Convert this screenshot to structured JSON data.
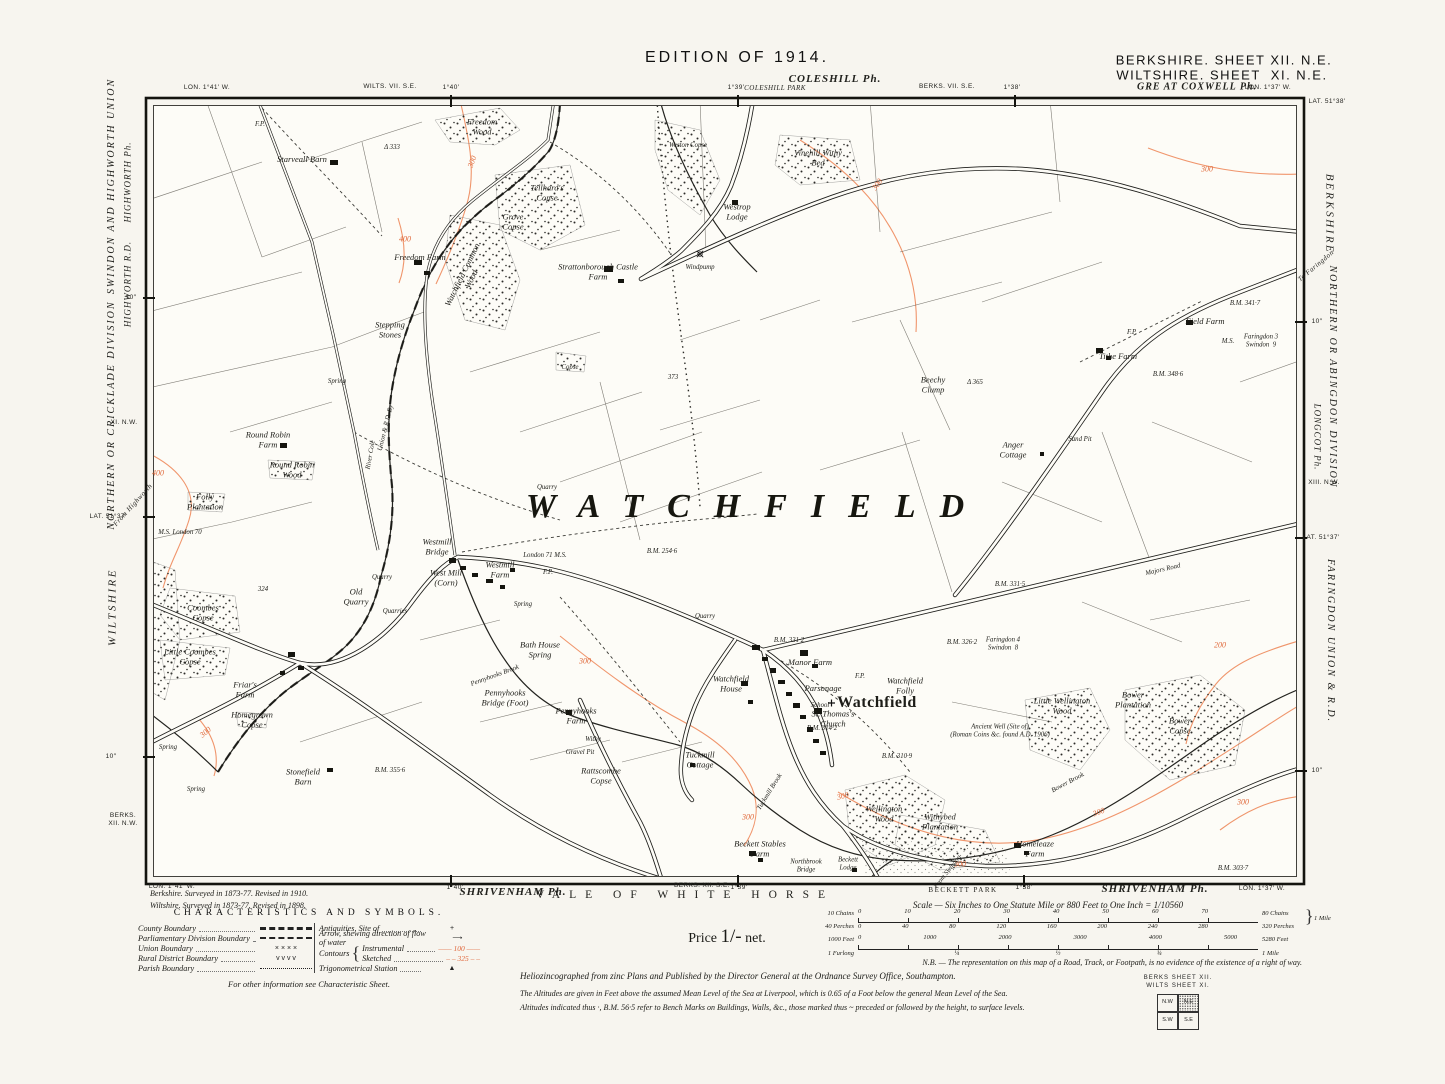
{
  "header": {
    "edition": "EDITION OF 1914.",
    "sheet_line1": "BERKSHIRE. SHEET XII. N.E.",
    "sheet_line2": "WILTSHIRE. SHEET  XI. N.E.",
    "great_coxwell": "GRE AT COXWELL Ph.",
    "coleshill": "COLESHILL Ph.",
    "coleshill_park": "COLESHILL PARK",
    "wilts_sheet": "WILTS. VII. S.E.",
    "berks_sheet": "BERKS. VII. S.E.",
    "lon_left": "LON. 1°41′ W.",
    "lon_right": "LON. 1°37′ W.",
    "lat_right": "LAT. 51°38′",
    "t140": "1°40′",
    "t139": "1°39′",
    "t138": "1°38′"
  },
  "margin_left": {
    "union": "SWINDON AND HIGHWORTH UNION",
    "parish": "HIGHWORTH Ph.",
    "rd": "HIGHWORTH R.D.",
    "division": "NORTHERN OR CRICKLADE DIVISION",
    "sheet_adj": "XI. N.W.",
    "lat": "LAT. 51°37′",
    "from_road": "From Highworth",
    "county": "WILTSHIRE",
    "sheet_corner": "BERKS.\nXII. N.W.",
    "tick": "10″"
  },
  "margin_right": {
    "county": "BERKSHIRE",
    "to_road": "To Faringdon",
    "division": "NORTHERN OR ABINGDON DIVISION",
    "parish": "LONGCOT Ph.",
    "sheet_adj": "XIII. N.W.",
    "lat": "LAT. 51°37′",
    "union": "FARINGDON UNION & R.D.",
    "tick": "10″"
  },
  "margin_bottom": {
    "lon_left": "LON. 1°41′ W.",
    "t140": "1°40′",
    "shrivenham_left": "SHRIVENHAM Ph.",
    "vale": "VALE OF WHITE HORSE",
    "berks_sheet": "BERKS. XII. S.E.",
    "t139": "1°39′",
    "beckett": "BECKETT PARK",
    "t138": "1°38′",
    "shrivenham_right": "SHRIVENHAM Ph.",
    "lon_right": "LON. 1°37′ W."
  },
  "map": {
    "big_label": "WATCHFIELD",
    "labels": [
      {
        "t": "F.P.",
        "x": 260,
        "y": 125,
        "c": "t"
      },
      {
        "t": "Freedom\nWood",
        "x": 482,
        "y": 127
      },
      {
        "t": "Starveall Barn",
        "x": 302,
        "y": 160
      },
      {
        "t": "Δ 333",
        "x": 392,
        "y": 148,
        "c": "t"
      },
      {
        "t": "Weston Copse",
        "x": 688,
        "y": 146,
        "c": "t"
      },
      {
        "t": "Vinehill Withy\nBed",
        "x": 818,
        "y": 158
      },
      {
        "t": "Westrop\nLodge",
        "x": 737,
        "y": 212
      },
      {
        "t": "Tellhard's\nCopse",
        "x": 547,
        "y": 193
      },
      {
        "t": "Grove\nCopse",
        "x": 513,
        "y": 222
      },
      {
        "t": "Freedom Farm",
        "x": 420,
        "y": 258
      },
      {
        "t": "Strattonborough Castle\nFarm",
        "x": 598,
        "y": 272
      },
      {
        "t": "Windpump",
        "x": 700,
        "y": 268,
        "c": "t"
      },
      {
        "t": "Watchfield Common\nWood",
        "x": 467,
        "y": 277,
        "r": -64
      },
      {
        "t": "Stepping\nStones",
        "x": 390,
        "y": 330
      },
      {
        "t": "Spring",
        "x": 337,
        "y": 382,
        "c": "t"
      },
      {
        "t": "300",
        "x": 473,
        "y": 162,
        "c": "red",
        "r": -70
      },
      {
        "t": "400",
        "x": 405,
        "y": 240,
        "c": "red"
      },
      {
        "t": "300",
        "x": 878,
        "y": 185,
        "c": "red",
        "r": -55
      },
      {
        "t": "300",
        "x": 1207,
        "y": 170,
        "c": "red"
      },
      {
        "t": "Round Robin\nFarm",
        "x": 268,
        "y": 440
      },
      {
        "t": "Round Robin\nWood",
        "x": 292,
        "y": 470
      },
      {
        "t": "Folly\nPlantation",
        "x": 205,
        "y": 502
      },
      {
        "t": "400",
        "x": 158,
        "y": 474,
        "c": "red"
      },
      {
        "t": "Copse",
        "x": 570,
        "y": 368,
        "c": "t"
      },
      {
        "t": "373",
        "x": 673,
        "y": 378,
        "c": "t"
      },
      {
        "t": "Beechy\nClump",
        "x": 933,
        "y": 385
      },
      {
        "t": "Δ 365",
        "x": 975,
        "y": 383,
        "c": "t"
      },
      {
        "t": "Tithe Farm",
        "x": 1118,
        "y": 357
      },
      {
        "t": "Field Farm",
        "x": 1205,
        "y": 322
      },
      {
        "t": "B.M. 341·7",
        "x": 1245,
        "y": 304,
        "c": "t"
      },
      {
        "t": "B.M. 348·6",
        "x": 1168,
        "y": 375,
        "c": "t"
      },
      {
        "t": "F.P.",
        "x": 1132,
        "y": 333,
        "c": "t"
      },
      {
        "t": "M.S.",
        "x": 1228,
        "y": 342,
        "c": "t"
      },
      {
        "t": "Faringdon 3\nSwindon  9",
        "x": 1261,
        "y": 341,
        "c": "t"
      },
      {
        "t": "Sand Pit",
        "x": 1080,
        "y": 440,
        "c": "t"
      },
      {
        "t": "Anger\nCottage",
        "x": 1013,
        "y": 450
      },
      {
        "t": "Union & R.D. By",
        "x": 386,
        "y": 428,
        "r": -76,
        "c": "t"
      },
      {
        "t": "River Cole",
        "x": 371,
        "y": 455,
        "r": -80,
        "c": "t"
      },
      {
        "t": "M.S. London 70",
        "x": 180,
        "y": 533,
        "c": "t"
      },
      {
        "t": "Quarry",
        "x": 547,
        "y": 488,
        "c": "t"
      },
      {
        "t": "Westmill\nBridge",
        "x": 437,
        "y": 547
      },
      {
        "t": "London 71 M.S.",
        "x": 545,
        "y": 556,
        "c": "t"
      },
      {
        "t": "B.M. 254·6",
        "x": 662,
        "y": 552,
        "c": "t"
      },
      {
        "t": "West Mill\n(Corn)",
        "x": 446,
        "y": 578
      },
      {
        "t": "Westmill\nFarm",
        "x": 500,
        "y": 570
      },
      {
        "t": "324",
        "x": 263,
        "y": 590,
        "c": "t"
      },
      {
        "t": "Quarry",
        "x": 382,
        "y": 578,
        "c": "t"
      },
      {
        "t": "Old\nQuarry",
        "x": 356,
        "y": 597
      },
      {
        "t": "Quarries",
        "x": 395,
        "y": 612,
        "c": "t"
      },
      {
        "t": "Spring",
        "x": 523,
        "y": 605,
        "c": "t"
      },
      {
        "t": "Coombes\nCopse",
        "x": 203,
        "y": 613
      },
      {
        "t": "Little Coombes\nCopse",
        "x": 190,
        "y": 657
      },
      {
        "t": "Friar's\nFarm",
        "x": 245,
        "y": 690
      },
      {
        "t": "Homegrown\nCopse",
        "x": 252,
        "y": 720
      },
      {
        "t": "Spring",
        "x": 168,
        "y": 748,
        "c": "t"
      },
      {
        "t": "Spring",
        "x": 196,
        "y": 790,
        "c": "t"
      },
      {
        "t": "300",
        "x": 206,
        "y": 733,
        "c": "red",
        "r": -40
      },
      {
        "t": "Stonefield\nBarn",
        "x": 303,
        "y": 777
      },
      {
        "t": "B.M. 355·6",
        "x": 390,
        "y": 771,
        "c": "t"
      },
      {
        "t": "Bath House\nSpring",
        "x": 540,
        "y": 650
      },
      {
        "t": "300",
        "x": 585,
        "y": 662,
        "c": "red"
      },
      {
        "t": "Pennyhooks Brook",
        "x": 495,
        "y": 676,
        "r": -20,
        "c": "t"
      },
      {
        "t": "Pennyhooks\nBridge (Foot)",
        "x": 505,
        "y": 698
      },
      {
        "t": "Pennyhooks\nFarm",
        "x": 576,
        "y": 716
      },
      {
        "t": "Withy",
        "x": 593,
        "y": 740,
        "c": "t"
      },
      {
        "t": "Gravel Pit",
        "x": 580,
        "y": 753,
        "c": "t"
      },
      {
        "t": "Rattscombe\nCopse",
        "x": 601,
        "y": 776
      },
      {
        "t": "F.P.",
        "x": 548,
        "y": 573,
        "c": "t"
      },
      {
        "t": "F.P.",
        "x": 860,
        "y": 677,
        "c": "t"
      },
      {
        "t": "Quarry",
        "x": 705,
        "y": 617,
        "c": "t"
      },
      {
        "t": "B.M. 331·2",
        "x": 789,
        "y": 641,
        "c": "t"
      },
      {
        "t": "Manor Farm",
        "x": 810,
        "y": 663
      },
      {
        "t": "Watchfield\nHouse",
        "x": 731,
        "y": 684
      },
      {
        "t": "Parsonage",
        "x": 823,
        "y": 689
      },
      {
        "t": "School",
        "x": 820,
        "y": 706,
        "c": "t"
      },
      {
        "t": "St. Thomas's\nChurch",
        "x": 833,
        "y": 719
      },
      {
        "t": "B.M. 314·2",
        "x": 822,
        "y": 729,
        "c": "t"
      },
      {
        "t": "Watchfield",
        "x": 877,
        "y": 703,
        "c": "v"
      },
      {
        "t": "Watchfield\nFolly",
        "x": 905,
        "y": 686
      },
      {
        "t": "B.M. 326·2",
        "x": 962,
        "y": 643,
        "c": "t"
      },
      {
        "t": "Faringdon 4\nSwindon  8",
        "x": 1003,
        "y": 644,
        "c": "t"
      },
      {
        "t": "B.M. 331·5",
        "x": 1010,
        "y": 585,
        "c": "t"
      },
      {
        "t": "Majors Road",
        "x": 1163,
        "y": 570,
        "r": -13,
        "c": "t"
      },
      {
        "t": "200",
        "x": 1220,
        "y": 646,
        "c": "red"
      },
      {
        "t": "Ancient Well (Site of)\n(Roman Coins &c. found A.D. 1906)",
        "x": 1000,
        "y": 731,
        "c": "t"
      },
      {
        "t": "Little Wellington\nWood",
        "x": 1062,
        "y": 706
      },
      {
        "t": "Bower\nPlantation",
        "x": 1133,
        "y": 700
      },
      {
        "t": "Bower\nCopse",
        "x": 1180,
        "y": 726
      },
      {
        "t": "Bower Brook",
        "x": 1068,
        "y": 783,
        "r": -28,
        "c": "t"
      },
      {
        "t": "300",
        "x": 1099,
        "y": 813,
        "c": "red",
        "r": -20
      },
      {
        "t": "300",
        "x": 1243,
        "y": 803,
        "c": "red"
      },
      {
        "t": "Wellington\nWood",
        "x": 884,
        "y": 814
      },
      {
        "t": "Withybed\nPlantation",
        "x": 940,
        "y": 822
      },
      {
        "t": "300",
        "x": 843,
        "y": 797,
        "c": "red",
        "r": -15
      },
      {
        "t": "300",
        "x": 748,
        "y": 818,
        "c": "red"
      },
      {
        "t": "B.M. 310·9",
        "x": 897,
        "y": 757,
        "c": "t"
      },
      {
        "t": "Tuckmill\nCottage",
        "x": 700,
        "y": 760
      },
      {
        "t": "Tuckmill Brook",
        "x": 770,
        "y": 792,
        "r": -58,
        "c": "t"
      },
      {
        "t": "Homeleaze\nFarm",
        "x": 1035,
        "y": 849
      },
      {
        "t": "B.M. 303·7",
        "x": 1233,
        "y": 869,
        "c": "t"
      },
      {
        "t": "Beckett Stables\nFarm",
        "x": 760,
        "y": 849
      },
      {
        "t": "Northbrook\nBridge",
        "x": 806,
        "y": 866,
        "c": "t"
      },
      {
        "t": "Beckett\nLodge",
        "x": 848,
        "y": 864,
        "c": "t"
      },
      {
        "t": "300",
        "x": 960,
        "y": 865,
        "c": "red"
      },
      {
        "t": "From Swindon",
        "x": 948,
        "y": 872,
        "r": -52,
        "c": "t"
      }
    ]
  },
  "legend": {
    "title": "CHARACTERISTICS AND SYMBOLS.",
    "left_rows": [
      {
        "label": "County Boundary",
        "glyph": ""
      },
      {
        "label": "Parliamentary Division Boundary",
        "glyph": ""
      },
      {
        "label": "Union Boundary",
        "glyph": "×      ×      ×      ×"
      },
      {
        "label": "Rural District Boundary",
        "glyph": "v      v      v      v"
      },
      {
        "label": "Parish Boundary",
        "glyph": ""
      }
    ],
    "antiquities_label": "Antiquities, Site of",
    "antiquities_glyph": "+",
    "arrow_label": "Arrow, shewing direction of flow of water",
    "arrow_glyph": "⟶",
    "contours_label": "Contours",
    "instrumental_label": "Instrumental",
    "instrumental_sample": "—— 100 ——",
    "sketched_label": "Sketched",
    "sketched_sample": "‒ ‒ 325 ‒ ‒",
    "trig_label": "Trigonometrical Station",
    "trig_glyph": "▲",
    "footnote": "For other information see Characteristic Sheet."
  },
  "price": {
    "label": "Price",
    "value": "1/-",
    "suffix": "net."
  },
  "scale": {
    "title": "Scale — Six Inches to One Statute Mile or 880 Feet to One Inch = 1/10560",
    "chains_label": "10 Chains",
    "chains_nums": [
      "0",
      "10",
      "20",
      "30",
      "40",
      "50",
      "60",
      "70"
    ],
    "chains_right": "80 Chains",
    "perches_label": "40 Perches",
    "perches_nums": [
      "0",
      "40",
      "80",
      "120",
      "160",
      "200",
      "240",
      "280"
    ],
    "perches_right": "320 Perches",
    "mile_right": "1 Mile",
    "feet_label": "1000 Feet",
    "feet_nums": [
      "0",
      "1000",
      "2000",
      "3000",
      "4000",
      "5000"
    ],
    "feet_right": "5280 Feet",
    "furlong_label": "1 Furlong",
    "furlong_nums": [
      "¼",
      "½",
      "¾"
    ],
    "furlong_right": "1 Mile"
  },
  "notes": {
    "survey1": "Berkshire.  Surveyed in 1873-77.  Revised in 1910.",
    "survey2": "Wiltshire.  Surveyed in 1873-77.  Revised in 1898.",
    "nb": "N.B. — The representation on this map of a Road, Track, or Footpath, is no evidence of the existence of a right of way.",
    "pub1": "Heliozincographed from zinc Plans and Published by the Director General at the Ordnance Survey Office, Southampton.",
    "pub2": "The Altitudes are given in Feet above the assumed Mean Level of the Sea at Liverpool, which is 0.65 of a Foot below the general Mean Level of the Sea.",
    "pub3": "Altitudes indicated thus ·, B.M. 56·5 refer to Bench Marks on Buildings, Walls, &c., those marked thus ~ preceded or followed by the height, to surface levels."
  },
  "index": {
    "line1": "BERKS   SHEET   XII.",
    "line2": "WILTS   SHEET   XI.",
    "nw": "N.W",
    "ne": "N.E",
    "sw": "S.W",
    "se": "S.E"
  }
}
